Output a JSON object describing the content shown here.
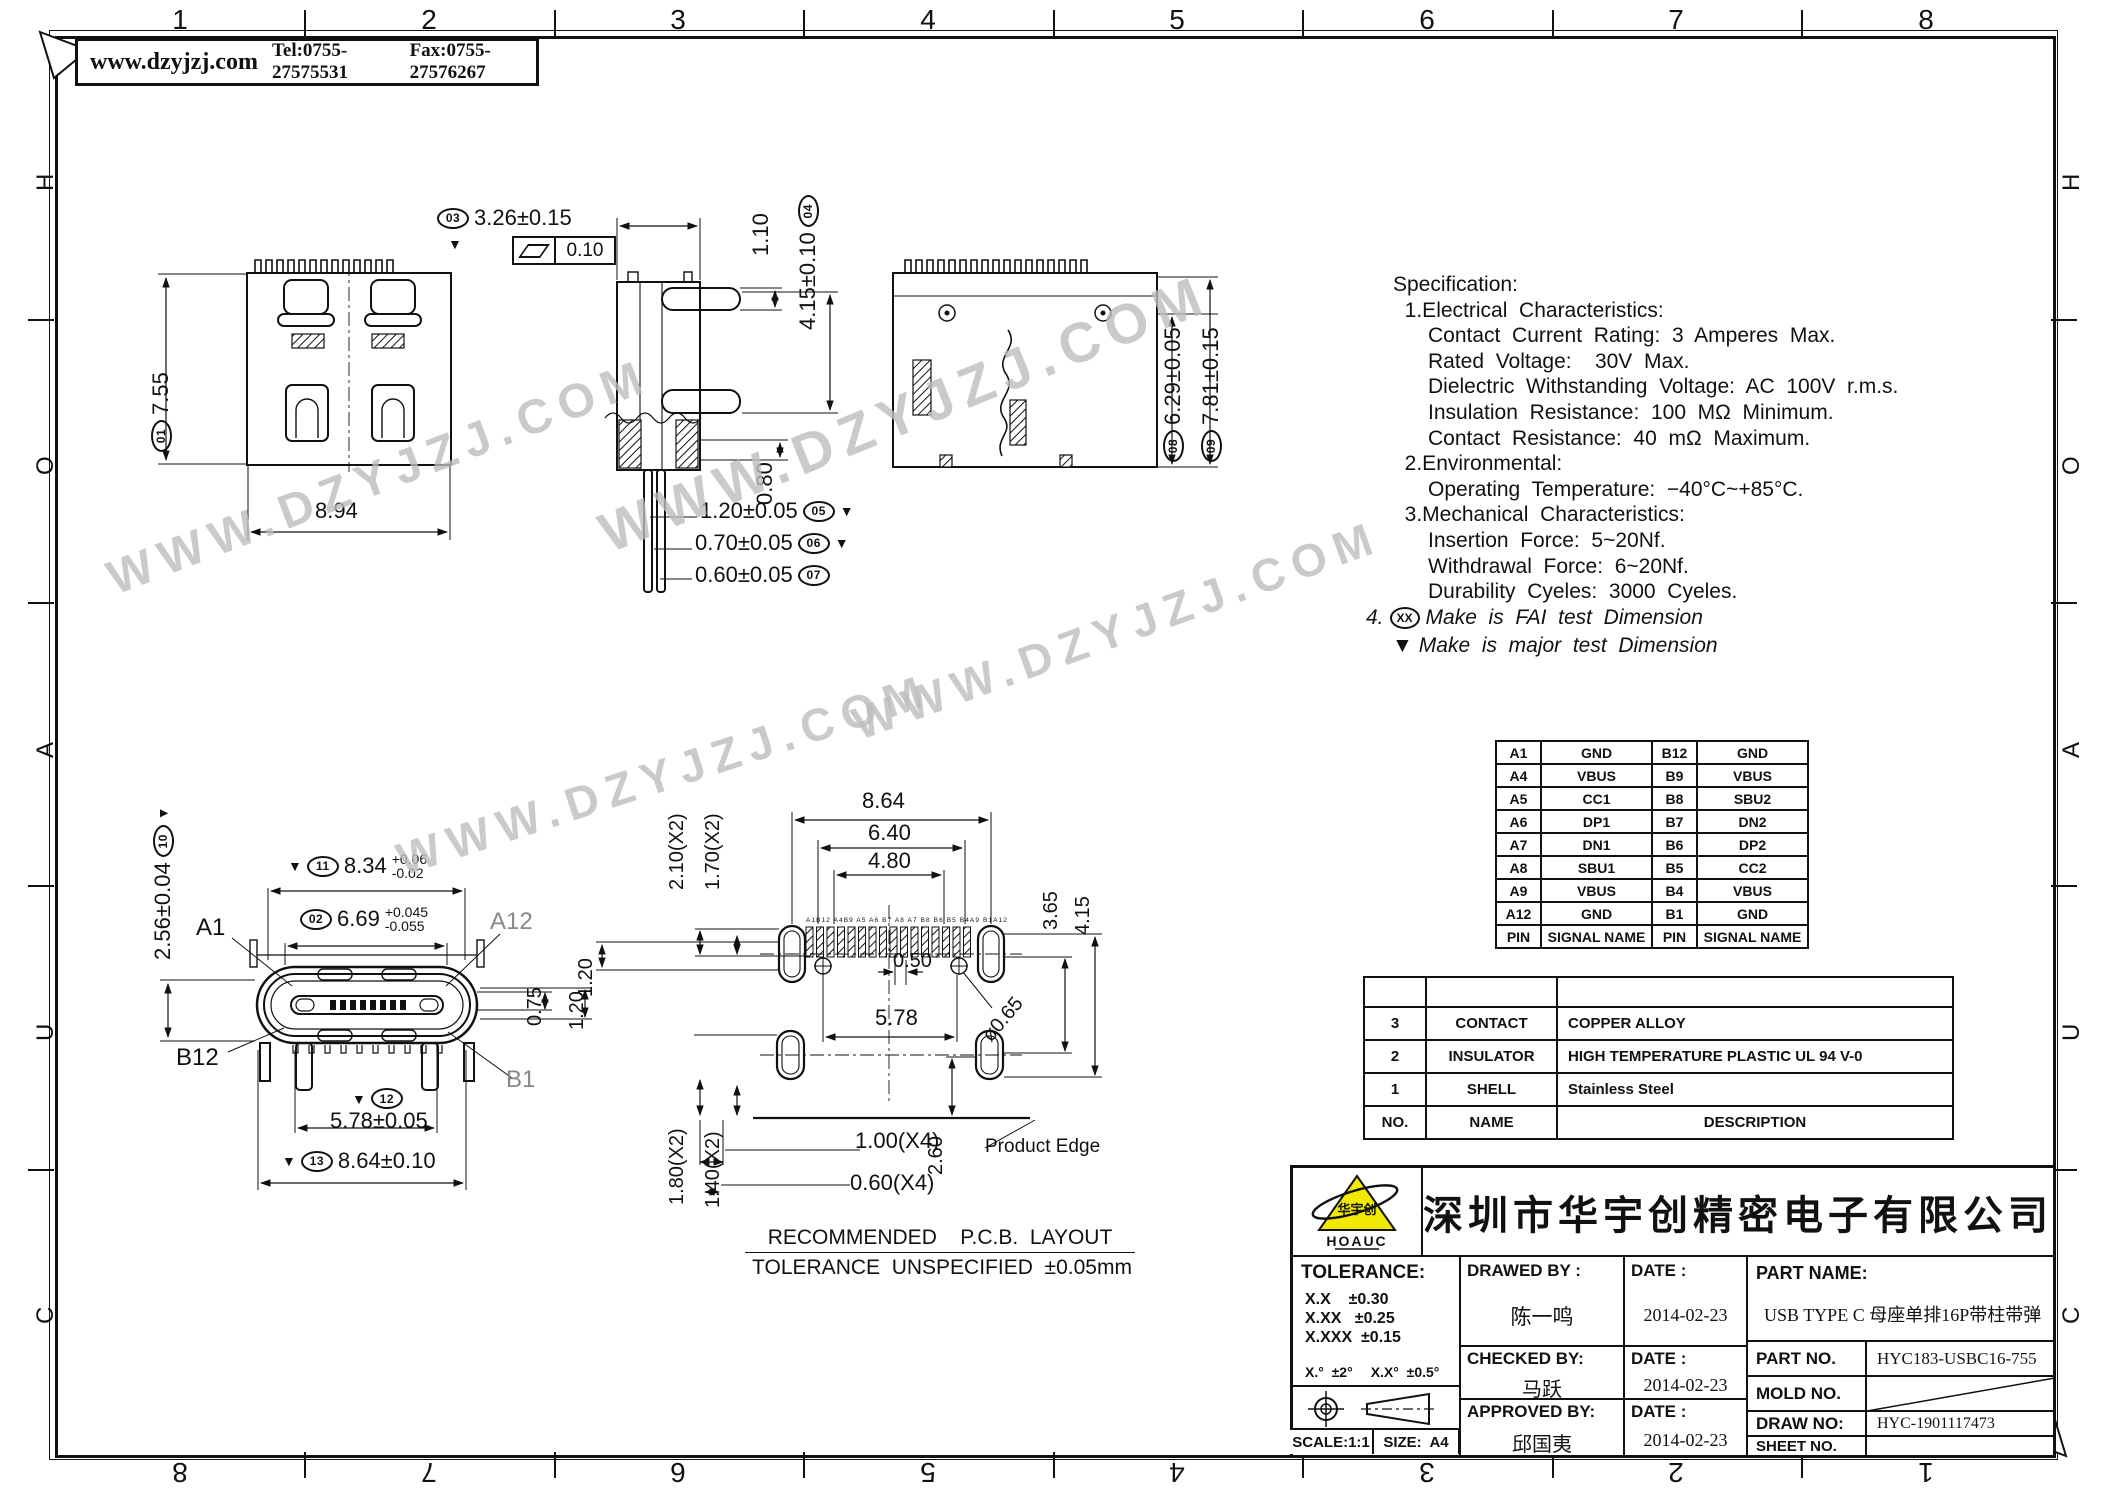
{
  "frame": {
    "top_numbers": [
      "1",
      "2",
      "3",
      "4",
      "5",
      "6",
      "7",
      "8"
    ],
    "bottom_numbers": [
      "8",
      "7",
      "6",
      "5",
      "4",
      "3",
      "2",
      "1"
    ],
    "left_letters": [
      "H",
      "O",
      "A",
      "U",
      "C"
    ],
    "right_letters": [
      "H",
      "O",
      "A",
      "U",
      "C"
    ]
  },
  "header_box": {
    "website": "www.dzyjzj.com",
    "tel": "Tel:0755-27575531",
    "fax": "Fax:0755-27576267"
  },
  "watermark": {
    "text": "WWW.DZYJZJ.COM"
  },
  "spec": {
    "lines": [
      "Specification:",
      "  1.Electrical  Characteristics:",
      "      Contact  Current  Rating:  3  Amperes  Max.",
      "      Rated  Voltage:    30V  Max.",
      "      Dielectric  Withstanding  Voltage:  AC  100V  r.m.s.",
      "      Insulation  Resistance:  100  MΩ  Minimum.",
      "      Contact  Resistance:  40  mΩ  Maximum.",
      "  2.Environmental:",
      "      Operating  Temperature:  −40°C~+85°C.",
      "  3.Mechanical  Characteristics:",
      "      Insertion  Force:  5~20Nf.",
      "      Withdrawal  Force:  6~20Nf.",
      "      Durability  Cyeles:  3000  Cyeles."
    ],
    "note4_prefix": "4.",
    "note4_oval": "XX",
    "note4_text": "Make  is  FAI  test  Dimension",
    "note5_mark": "▼",
    "note5_text": "Make  is  major  test  Dimension"
  },
  "views": {
    "v1": {
      "d01_num": "01",
      "d01": "7.55",
      "d894": "8.94"
    },
    "v2": {
      "d03_num": "03",
      "d03": "3.26±0.15",
      "fcf_val": "0.10",
      "d110": "1.10",
      "d04": "4.15±0.10",
      "d04_num": "04",
      "d080": "0.80",
      "d05": "1.20±0.05",
      "d05_num": "05",
      "d05_mark": "▼",
      "d06": "0.70±0.05",
      "d06_num": "06",
      "d06_mark": "▼",
      "d07": "0.60±0.05",
      "d07_num": "07"
    },
    "v3": {
      "d08_num": "08",
      "d08": "6.29±0.05",
      "d09_num": "09",
      "d09": "7.81±0.15"
    },
    "v4": {
      "d10": "2.56±0.04",
      "d10_num": "10",
      "d10_mark": "▼",
      "d11_mark": "▼",
      "d11_num": "11",
      "d11": "8.34",
      "d11_up": "+0.06",
      "d11_dn": "-0.02",
      "d02_num": "02",
      "d02": "6.69",
      "d02_up": "+0.045",
      "d02_dn": "-0.055",
      "a1": "A1",
      "a12": "A12",
      "b12": "B12",
      "b1": "B1",
      "d075": "0.75",
      "d120": "1.20",
      "d12_mark": "▼",
      "d12_num": "12",
      "d12": "5.78±0.05",
      "d13_mark": "▼",
      "d13_num": "13",
      "d13": "8.64±0.10"
    },
    "v5": {
      "d864": "8.64",
      "d640": "6.40",
      "d480": "4.80",
      "d210": "2.10(X2)",
      "d170": "1.70(X2)",
      "d120": "1.20",
      "d050": "0.50",
      "d578": "5.78",
      "d065": "ø0.65",
      "d365": "3.65",
      "d415": "4.15",
      "d180": "1.80(X2)",
      "d140": "1.40(X2)",
      "d100": "1.00(X4)",
      "d060": "0.60(X4)",
      "d260": "2.60",
      "product_edge": "Product Edge",
      "pad_labels": "A1B12 A4B9 A5 A6 B7 A8 A7 B8 B6 B5 B4A9 B1A12"
    },
    "caption": {
      "line1": "RECOMMENDED    P.C.B.  LAYOUT",
      "line2": "TOLERANCE  UNSPECIFIED  ±0.05mm"
    }
  },
  "pin_table": {
    "rows": [
      [
        "A1",
        "GND",
        "B12",
        "GND"
      ],
      [
        "A4",
        "VBUS",
        "B9",
        "VBUS"
      ],
      [
        "A5",
        "CC1",
        "B8",
        "SBU2"
      ],
      [
        "A6",
        "DP1",
        "B7",
        "DN2"
      ],
      [
        "A7",
        "DN1",
        "B6",
        "DP2"
      ],
      [
        "A8",
        "SBU1",
        "B5",
        "CC2"
      ],
      [
        "A9",
        "VBUS",
        "B4",
        "VBUS"
      ],
      [
        "A12",
        "GND",
        "B1",
        "GND"
      ],
      [
        "PIN",
        "SIGNAL NAME",
        "PIN",
        "SIGNAL NAME"
      ]
    ]
  },
  "materials": {
    "rows": [
      [
        "3",
        "CONTACT",
        "COPPER ALLOY"
      ],
      [
        "2",
        "INSULATOR",
        "HIGH TEMPERATURE PLASTIC UL 94 V-0"
      ],
      [
        "1",
        "SHELL",
        "Stainless Steel"
      ],
      [
        "NO.",
        "NAME",
        "DESCRIPTION"
      ]
    ]
  },
  "title_block": {
    "logo_text": "HOAUC",
    "logo_cn": "华宇创",
    "company": "深圳市华宇创精密电子有限公司",
    "tolerance_title": "TOLERANCE:",
    "tol1": "X.X    ±0.30",
    "tol2": "X.XX   ±0.25",
    "tol3": "X.XXX  ±0.15",
    "ang1": "X.°  ±2°",
    "ang2": "X.X°  ±0.5°",
    "unit": "UNIT:  mm  [inch]",
    "scale": "SCALE:1:1",
    "size": "SIZE:  A4",
    "drawed_by_label": "DRAWED  BY :",
    "drawed_by": "陈一鸣",
    "date_label1": "DATE :",
    "date1": "2014-02-23",
    "checked_by_label": "CHECKED  BY:",
    "checked_by": "马跃",
    "date_label2": "DATE :",
    "date2": "2014-02-23",
    "approved_by_label": "APPROVED  BY:",
    "approved_by": "邱国夷",
    "date_label3": "DATE :",
    "date3": "2014-02-23",
    "part_name_label": "PART  NAME:",
    "part_name": "USB TYPE C 母座单排16P带柱带弹",
    "part_no_label": "PART  NO.",
    "part_no": "HYC183-USBC16-755",
    "mold_no_label": "MOLD  NO.",
    "draw_no_label": "DRAW  NO:",
    "draw_no": "HYC-1901117473",
    "sheet_no_label": "SHEET  NO."
  }
}
